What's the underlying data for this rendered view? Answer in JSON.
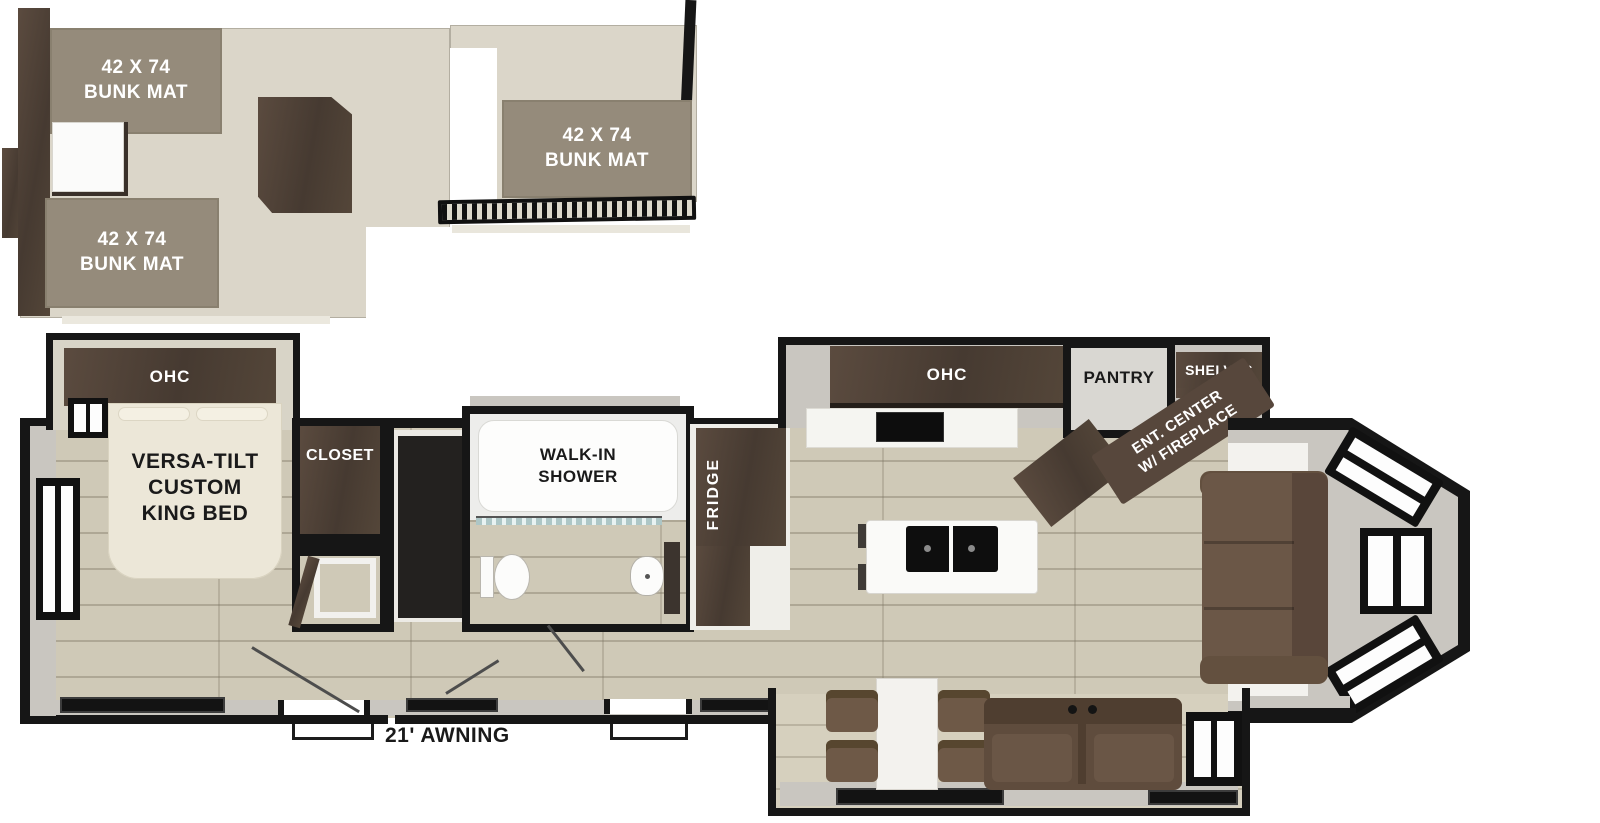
{
  "loft": {
    "bunk_mat_left_top": "42 X 74\nBUNK MAT",
    "bunk_mat_left_bottom": "42 X 74\nBUNK MAT",
    "bunk_mat_right": "42 X 74\nBUNK MAT"
  },
  "bedroom": {
    "ohc": "OHC",
    "bed": "VERSA-TILT\nCUSTOM\nKING BED",
    "closet": "CLOSET"
  },
  "bathroom": {
    "shower": "WALK-IN\nSHOWER"
  },
  "kitchen": {
    "fridge": "FRIDGE",
    "ohc": "OHC",
    "pantry": "PANTRY",
    "shelves": "SHELVES",
    "ent_center": "ENT. CENTER\nW/ FIREPLACE"
  },
  "exterior": {
    "awning": "21' AWNING"
  },
  "colors": {
    "wall": "#161616",
    "loft_floor": "#dbd6c9",
    "wood_floor": "#cfc9b7",
    "bunk_mat": "#958b7b",
    "dark_cabinet": "#4f4237",
    "bed_cream": "#ece7d8",
    "sofa_brown": "#6b5747",
    "label_white": "#ffffff",
    "label_black": "#1a1a1a"
  }
}
